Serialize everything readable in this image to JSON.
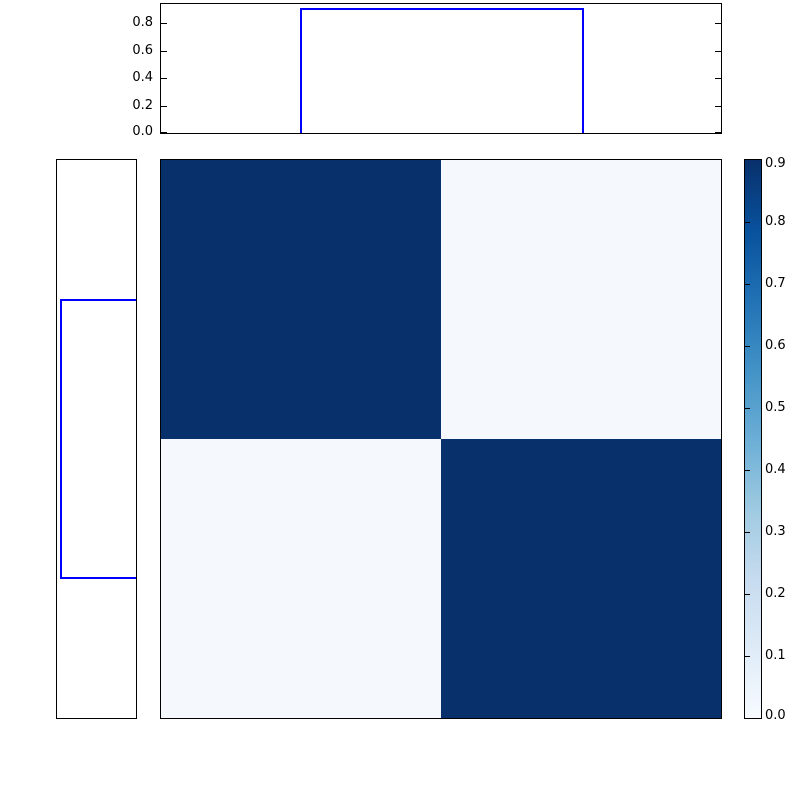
{
  "chart_data": {
    "type": "heatmap",
    "title": "",
    "description": "2x2 block similarity matrix with marginal cluster-indicator step plots and a Blues colorbar",
    "matrix": {
      "n_rows": 2,
      "n_cols": 2,
      "values": [
        [
          0.9,
          0.05
        ],
        [
          0.05,
          0.9
        ]
      ],
      "colormap": "Blues",
      "vmin": 0.0,
      "vmax": 0.9,
      "cell_colors": [
        [
          "#08306b",
          "#f5f9fd"
        ],
        [
          "#f5f9fd",
          "#08306b"
        ]
      ]
    },
    "top_marginal": {
      "type": "step",
      "line_color": "#0000ff",
      "x": [
        0.0,
        0.25,
        0.25,
        0.75,
        0.75,
        1.0
      ],
      "y": [
        0.0,
        0.0,
        0.9,
        0.9,
        0.0,
        0.0
      ],
      "ylim": [
        0.0,
        0.94
      ],
      "ytick_labels": [
        "0.0",
        "0.2",
        "0.4",
        "0.6",
        "0.8"
      ],
      "grid": false
    },
    "left_marginal": {
      "type": "step",
      "orientation": "vertical",
      "line_color": "#0000ff",
      "y": [
        0.0,
        0.25,
        0.25,
        0.75,
        0.75,
        1.0
      ],
      "x": [
        0.0,
        0.0,
        0.9,
        0.9,
        0.0,
        0.0
      ],
      "xlim_inverted": [
        0.94,
        0.0
      ],
      "tick_labels": [],
      "grid": false
    },
    "colorbar": {
      "position": "right",
      "colormap": "Blues",
      "range": [
        0.0,
        0.9
      ],
      "tick_labels": [
        "0.0",
        "0.1",
        "0.2",
        "0.3",
        "0.4",
        "0.5",
        "0.6",
        "0.7",
        "0.8",
        "0.9"
      ],
      "gradient_stops_top_to_bottom": [
        "#08306b",
        "#08519c",
        "#2171b5",
        "#4292c6",
        "#6baed6",
        "#9ecae1",
        "#c6dbef",
        "#deebf7",
        "#f7fbff"
      ]
    },
    "layout_hints": {
      "frame_color": "#000000",
      "background": "#ffffff",
      "tick_direction": "in"
    }
  }
}
